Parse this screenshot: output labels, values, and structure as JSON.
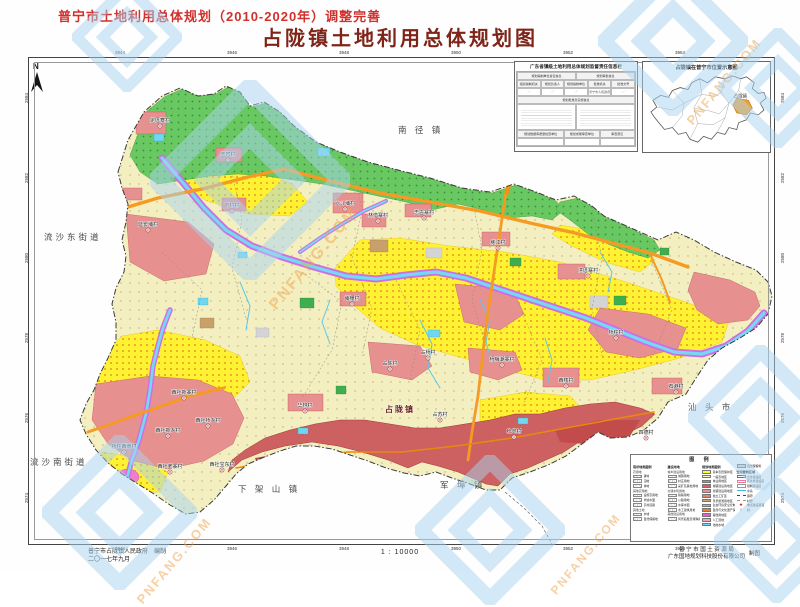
{
  "page": {
    "title_top": "普宁市土地利用总体规划（2010-2020年）调整完善",
    "title_main": "占陇镇土地利用总体规划图",
    "north_label": "N"
  },
  "grid": {
    "top": [
      "3944",
      "3946",
      "3948",
      "3950",
      "3952",
      "3954"
    ],
    "bottom": [
      "3944",
      "3946",
      "3948",
      "3950",
      "3952",
      "3954"
    ],
    "left": [
      "2584",
      "2582",
      "2580",
      "2578",
      "2576",
      "2574"
    ],
    "right": [
      "2584",
      "2582",
      "2580",
      "2578",
      "2576",
      "2574"
    ]
  },
  "insets": {
    "info_table": {
      "title": "广东省镇级土地利用总体规划监督责任信息栏",
      "group_headers": [
        "规划编制单位责任信息",
        "规划审批信息"
      ],
      "col_headers": [
        "组织编制机关",
        "规划负责人",
        "规划编制单位",
        "批准机关",
        "批准文号"
      ],
      "col_values": [
        "／",
        "／",
        "／",
        "普宁市人民政府",
        "／"
      ],
      "mid_header": "规划批准及实施信息",
      "bottom_headers": [
        "规划数据库质量检查单位",
        "规划成果审查单位",
        "审查意见"
      ]
    },
    "location": {
      "title": "占陇镇在普宁市位置示意图",
      "highlight_label": "占陇镇"
    }
  },
  "map": {
    "town_center_label": "占陇镇",
    "neighbors": [
      {
        "label": "南 径 镇",
        "x": 398,
        "y": 133
      },
      {
        "label": "流沙东街道",
        "x": 44,
        "y": 240,
        "small": true
      },
      {
        "label": "流沙南街道",
        "x": 30,
        "y": 465,
        "small": true
      },
      {
        "label": "下 架 山 镇",
        "x": 238,
        "y": 492
      },
      {
        "label": "军 埠 镇",
        "x": 440,
        "y": 488
      },
      {
        "label": "汕 头 市",
        "x": 688,
        "y": 410
      }
    ],
    "villages": [
      {
        "name": "定厝寮村",
        "x": 160,
        "y": 122
      },
      {
        "name": "玉窖村",
        "x": 228,
        "y": 156
      },
      {
        "name": "下村村",
        "x": 232,
        "y": 207
      },
      {
        "name": "延长埔村",
        "x": 148,
        "y": 226
      },
      {
        "name": "六斗埔村",
        "x": 345,
        "y": 205
      },
      {
        "name": "林惜寨村",
        "x": 378,
        "y": 217
      },
      {
        "name": "志古寨村",
        "x": 424,
        "y": 214
      },
      {
        "name": "练江村",
        "x": 498,
        "y": 244
      },
      {
        "name": "洪厝寨村",
        "x": 588,
        "y": 272
      },
      {
        "name": "桥柱村",
        "x": 616,
        "y": 334
      },
      {
        "name": "埔栅村",
        "x": 352,
        "y": 300
      },
      {
        "name": "杨梅潮寨村",
        "x": 502,
        "y": 361
      },
      {
        "name": "占杨村",
        "x": 428,
        "y": 354
      },
      {
        "name": "占陈村",
        "x": 390,
        "y": 365
      },
      {
        "name": "西楼村",
        "x": 566,
        "y": 382
      },
      {
        "name": "石港村",
        "x": 676,
        "y": 388
      },
      {
        "name": "朴兜村",
        "x": 514,
        "y": 433
      },
      {
        "name": "四德村",
        "x": 646,
        "y": 434
      },
      {
        "name": "占苏村",
        "x": 440,
        "y": 416
      },
      {
        "name": "华林村",
        "x": 305,
        "y": 407
      },
      {
        "name": "西社新寨村",
        "x": 184,
        "y": 394
      },
      {
        "name": "西社桥乡村",
        "x": 208,
        "y": 422
      },
      {
        "name": "西社新乡村",
        "x": 168,
        "y": 432
      },
      {
        "name": "桥柱西南村",
        "x": 124,
        "y": 448
      },
      {
        "name": "西社老寨村",
        "x": 170,
        "y": 468
      },
      {
        "name": "西社宝东村",
        "x": 222,
        "y": 466
      }
    ]
  },
  "legend": {
    "title": "图  例",
    "col1": {
      "header": "现状地类图例",
      "groups": [
        {
          "name": "农用地",
          "items": [
            {
              "label": "耕地",
              "sw": "hatch"
            },
            {
              "label": "园地",
              "sw": "dots"
            },
            {
              "label": "林地",
              "sw": "hatch"
            }
          ]
        },
        {
          "name": "其他农用地",
          "items": [
            {
              "label": "设施农用地",
              "sw": "dots"
            },
            {
              "label": "坑塘水面",
              "sw": "hatch"
            },
            {
              "label": "农村道路",
              "sw": "dots"
            }
          ]
        },
        {
          "name": "其他土地",
          "items": [
            {
              "label": "水域",
              "sw": "hatch"
            },
            {
              "label": "自然保留地",
              "sw": "dots"
            }
          ]
        }
      ]
    },
    "col2": {
      "header": "建设用地",
      "groups": [
        {
          "name": "城乡建设用地",
          "items": [
            {
              "label": "城镇用地",
              "sw": "hatch"
            },
            {
              "label": "村庄用地",
              "sw": "dots"
            },
            {
              "label": "采矿及其他用地",
              "sw": "hatch"
            }
          ]
        },
        {
          "name": "交通水利用地",
          "items": [
            {
              "label": "铁路用地",
              "sw": "hatch"
            },
            {
              "label": "公路用地",
              "sw": "dots"
            },
            {
              "label": "水库水面",
              "sw": "hatch"
            },
            {
              "label": "水工建筑用地",
              "sw": "dots"
            }
          ]
        },
        {
          "name": "其他建设用地",
          "items": [
            {
              "label": "风景名胜及特殊用地",
              "sw": "hatch"
            }
          ]
        }
      ]
    },
    "col3": {
      "header": "规划地类图例",
      "items": [
        {
          "label": "基本农田保护区",
          "color": "#ffff2e"
        },
        {
          "label": "一般农地区",
          "color": "#fbf6b8"
        },
        {
          "label": "林业用地区",
          "color": "#5dc355"
        },
        {
          "label": "城镇建设用地区",
          "color": "#e45b5b"
        },
        {
          "label": "村镇建设用地区",
          "color": "#ea9292"
        },
        {
          "label": "独立工矿区",
          "color": "#d98a72"
        },
        {
          "label": "风景旅游用地区",
          "color": "#cfa070"
        },
        {
          "label": "生态环境安全控制区",
          "color": "#f5a337"
        },
        {
          "label": "自然与文化遗产保护区",
          "color": "#f07f2a"
        },
        {
          "label": "其他用地区",
          "color": "#e060c8"
        },
        {
          "label": "人工湿地",
          "color": "#f4a0c0"
        },
        {
          "label": "陆地水域",
          "color": "#6fd8f0"
        }
      ]
    },
    "col4": {
      "reserve": {
        "label": "自然保留地",
        "color": "#d9d9d9"
      },
      "header": "空间管制区域",
      "zones": [
        {
          "label": "允许建设区",
          "outline": "#e0308a"
        },
        {
          "label": "有条件建设区",
          "outline": "#e87ca0"
        },
        {
          "label": "限制建设区",
          "outline": "#999999"
        }
      ],
      "lines": [
        {
          "label": "水系",
          "style": "water"
        },
        {
          "label": "镇界",
          "style": "dashdot"
        },
        {
          "label": "村界",
          "style": "dash"
        }
      ],
      "symbols": [
        {
          "label": "重点建设项目",
          "glyph": "★",
          "color": "#d42020"
        },
        {
          "label": "村",
          "glyph": "○",
          "color": "#666666"
        }
      ]
    }
  },
  "footer": {
    "left_org": "普宁市占陇镇人民政府",
    "left_role": "编制",
    "left_date": "二〇一七年九月",
    "scale": "1 : 10000",
    "right_org": "普 宁 市 国 土 资 源 局",
    "right_company": "广东国地规划科技股份有限公司",
    "right_role": "制图"
  },
  "watermark": {
    "brand": "普宁房",
    "domain": "PNFANG.COM"
  }
}
